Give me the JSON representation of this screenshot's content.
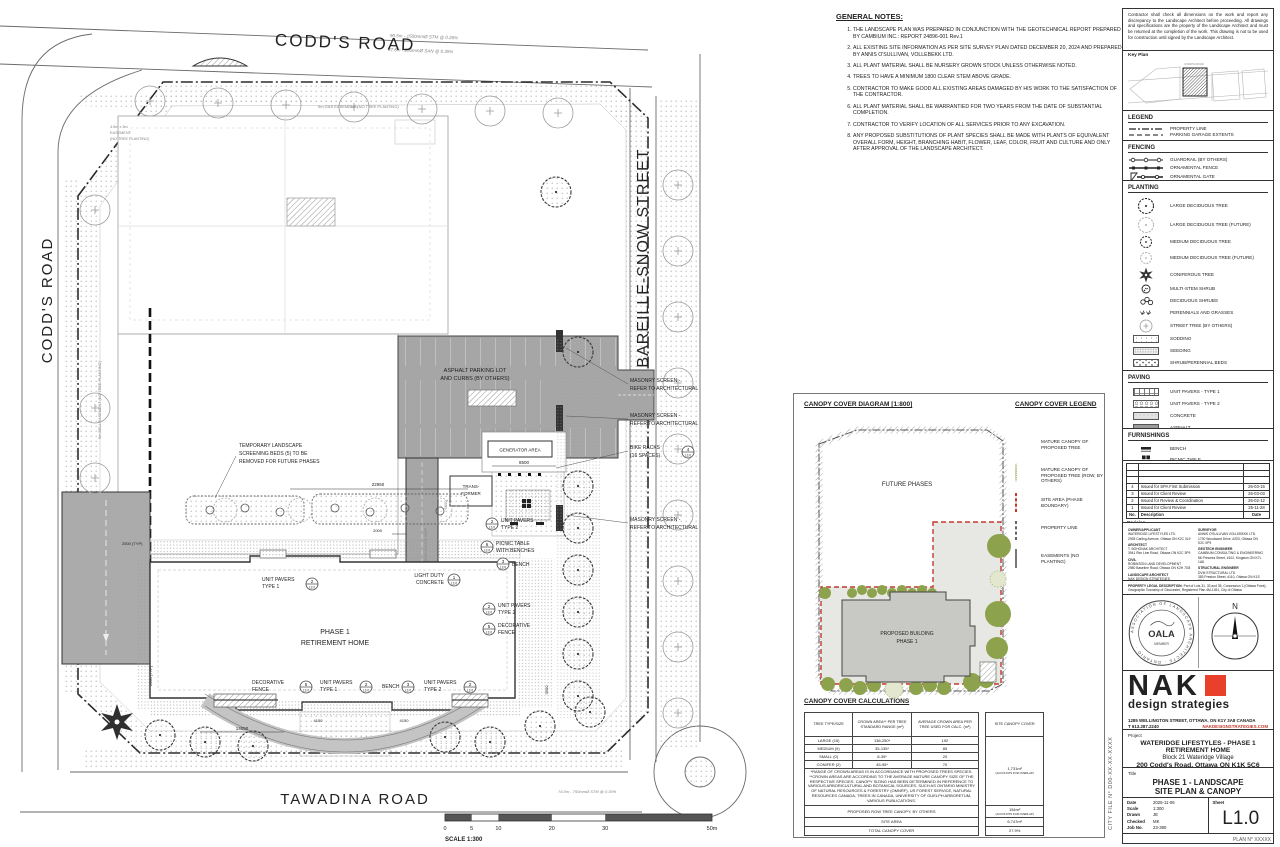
{
  "plan": {
    "street_top": "CODD'S ROAD",
    "street_left": "CODD'S ROAD",
    "street_right": "BAREILLE-SNOW STREET",
    "street_bottom": "TAWADINA ROAD",
    "asphalt1": "ASPHALT PARKING LOT",
    "asphalt2": "AND CURBS (BY OTHERS)",
    "generator": "GENERATOR AREA",
    "trans1": "TRANS-",
    "trans2": "FORMER",
    "masonry1": "MASONRY SCREEN -",
    "masonry2": "REFER TO ARCHITECTURAL",
    "bike1": "BIKE RACKS",
    "bike2": "(16 SPACES)",
    "temp1": "TEMPORARY LANDSCAPE",
    "temp2": "SCREENING BEDS (5) TO BE",
    "temp3": "REMOVED FOR FUTURE PHASES",
    "bldg1": "PHASE 1",
    "bldg2": "RETIREMENT HOME",
    "ramp": "EXTERNAL PARKING GARAGE RAMP",
    "lbl_up": "UNIT PAVERS",
    "lbl_t1": "TYPE 1",
    "lbl_t2": "TYPE 2",
    "lbl_picnic1": "PICNIC TABLE",
    "lbl_picnic2": "WITH BENCHES",
    "lbl_bench": "BENCH",
    "lbl_ldc1": "LIGHT DUTY",
    "lbl_ldc2": "CONCRETE",
    "lbl_fence1": "DECORATIVE",
    "lbl_fence2": "FENCE",
    "b1": "1",
    "b2": "2",
    "b3": "3",
    "b4": "4",
    "b5": "5",
    "b6": "6",
    "sheetref": "L3.0",
    "d22950": "22950",
    "d2000": "2000",
    "d8500": "8500",
    "d2500": "2500 (TYP)",
    "d3500": "3500",
    "d14050": "14050",
    "d4150": "4150",
    "d6500": "6500",
    "e_gas": "5m GAS EASEMENT (NO TREE PLANTING)",
    "e_corner1": "4.5m x 5m",
    "e_corner2": "EASEMENT",
    "e_corner3": "(NO TREE PLANTING)",
    "e_bell": "5m BELL EASEMENT (NO TREE PLANTING)",
    "survey1": "90.5m - 1500mmØ STM @ 0.26%",
    "survey2": "87.8m - 250mmØ SAN @ 0.35%",
    "survey3": "74.0m - 750mmØ STM @ 0.30%",
    "scale_label": "SCALE 1:300",
    "s0": "0",
    "s5": "5",
    "s10": "10",
    "s20": "20",
    "s30": "30",
    "s50": "50m"
  },
  "notes": {
    "title": "GENERAL NOTES:",
    "items": [
      "THE LANDSCAPE PLAN WAS PREPARED IN CONJUNCTION WITH THE GEOTECHNICAL REPORT PREPARED BY CAMBIUM INC.: REPORT 24896-001 Rev.1",
      "ALL EXISTING SITE INFORMATION AS PER SITE SURVEY PLAN DATED DECEMBER 20, 2024 AND PREPARED BY ANNIS O'SULLIVAN, VOLLEBEKK LTD.",
      "ALL PLANT MATERIAL SHALL BE NURSERY GROWN STOCK UNLESS OTHERWISE NOTED.",
      "TREES TO HAVE A MINIMUM 1800 CLEAR STEM ABOVE GRADE.",
      "CONTRACTOR TO MAKE GOOD ALL EXISTING AREAS DAMAGED BY HIS WORK TO THE  SATISFACTION OF THE CONTRACTOR.",
      "ALL PLANT MATERIAL SHALL BE WARRANTIED  FOR TWO YEARS FROM THE DATE OF  SUBSTANTIAL COMPLETION.",
      "CONTRACTOR TO VERIFY LOCATION OF ALL SERVICES PRIOR TO ANY EXCAVATION.",
      "ANY PROPOSED SUBSTITUTIONS OF PLANT SPECIES SHALL BE MADE WITH PLANTS OF EQUIVALENT OVERALL FORM, HEIGHT, BRANCHING HABIT, FLOWER, LEAF, COLOR, FRUIT AND CULTURE AND ONLY AFTER APPROVAL OF THE LANDSCAPE ARCHITECT."
    ]
  },
  "canopy": {
    "diagram_title": "CANOPY COVER DIAGRAM [1:800]",
    "legend_title": "CANOPY COVER LEGEND",
    "future": "FUTURE PHASES",
    "bldg1": "PROPOSED BUILDING",
    "bldg2": "PHASE 1",
    "legend": [
      "MATURE CANOPY OF PROPOSED TREE",
      "MATURE CANOPY OF PROPOSED TREE (ROW, BY OTHERS)",
      "SITE AREA (PHASE BOUNDARY)",
      "PROPERTY LINE",
      "EASEMENTS (NO PLANTING)"
    ],
    "calc_title": "CANOPY COVER CALCULATIONS",
    "h1": "TREE TYPE/SIZE",
    "h2": "CROWN AREA** PER TREE STANDARD RANGE (m²)",
    "h3": "AVERAGE CROWN AREA PER TREE USED FOR CALC. (m²)",
    "h4": "SITE CANOPY COVER",
    "rows": [
      [
        "LARGE (15)",
        "136-250*",
        "192"
      ],
      [
        "MEDIUM (9)",
        "35-135*",
        "85"
      ],
      [
        "SMALL (0)",
        "8-35*",
        "20"
      ],
      [
        "CONIFER (2)",
        "45-95*",
        "70"
      ]
    ],
    "site_canopy": "1,731m²",
    "overlap": "(ACCOUNTS FOR OVERLAP)",
    "footnote": "*RANGE OF CROWN AREAS IS IN ACCORDANCE WITH PROPOSED TREES SPECIES. **CROWN AREAS ARE ACCORDING TO THE AVERAGE MATURE CANOPY SIZE OF THE RESPECTIVE SPECIES. CANOPY SIZING HAS BEEN DETERMINED IN REFERENCE TO VARIOUS ARBORICULTURAL AND BOTANICAL SOURCES, SUCH AS ONTARIO MINISTRY OF NATURAL RESOURCES & FORESTRY (OMNRF), US FOREST SERVICE, NATURAL RESOURCES CANADA, TREES IN CANADA, UNIVERSITY OF GUELPH ARBORETUM, VARIOUS PUBLICATIONS.",
    "row_label": "PROPOSED ROW TREE CANOPY, BY OTHERS",
    "row_value": "154m²",
    "sa_label": "SITE AREA",
    "sa_value": "6,747m²",
    "total_label": "TOTAL CANOPY COVER",
    "total_value": "27.9%"
  },
  "tb": {
    "disclaimer": "Contractor shall check all dimensions on the work and report any discrepancy to the Landscape Architect before proceeding.  All drawings and specifications are the property of the Landscape Architect and must be returned at the completion of the work.  This drawing is not to be used for construction until signed by the Landscape Architect.",
    "keyplan": "Key Plan",
    "keyplan_road": "CODD'S ROAD",
    "legend_title": "LEGEND",
    "legend": [
      "PROPERTY LINE",
      "PARKING GARAGE EXTENTS"
    ],
    "fencing_title": "FENCING",
    "fencing": [
      "GUARDRAIL (BY OTHERS)",
      "ORNAMENTAL FENCE",
      "ORNAMENTAL GATE"
    ],
    "planting_title": "PLANTING",
    "planting": [
      "LARGE DECIDUOUS TREE",
      "LARGE DECIDUOUS TREE (FUTURE)",
      "MEDIUM DECIDUOUS TREE",
      "MEDIUM DECIDUOUS TREE (FUTURE)",
      "CONIFEROUS TREE",
      "MULTI-STEM SHRUB",
      "DECIDUOUS SHRUBS",
      "PERENNIALS AND GRASSES",
      "STREET TREE (BY OTHERS)",
      "SODDING",
      "SEEDING",
      "SHRUB/PERENNIAL BEDS",
      "MULCH"
    ],
    "paving_title": "PAVING",
    "paving": [
      "UNIT PAVERS - TYPE 1",
      "UNIT PAVERS - TYPE 2",
      "CONCRETE",
      "ASPHALT"
    ],
    "furnishings_title": "FURNISHINGS",
    "furnishings": [
      "BENCH",
      "PICNIC TABLE"
    ],
    "rev_rows": [
      [
        "4",
        "Issued for SPA First Submission",
        "26-03-15"
      ],
      [
        "3",
        "Issued for Client Review",
        "26-03-03"
      ],
      [
        "2",
        "Issued for Review & Coordination",
        "26-02-12"
      ],
      [
        "1",
        "Issued for Client Review",
        "25-11-28"
      ]
    ],
    "rev_no": "No.",
    "rev_desc": "Description",
    "rev_date": "Date",
    "rev_footer": "Revision",
    "cons_left": [
      {
        "role": "OWNER/APPLICANT",
        "firm": "WATERIDGE LIFESTYLES LTD.",
        "addr": "2935 Carling Avenue, Ottawa ON K2C 3L9"
      },
      {
        "role": "ARCHITECT",
        "firm": "T. BOHONAK ARCHITECT",
        "addr": "3941 Rim Line Road, Ottawa ON K2C 3P9"
      },
      {
        "role": "CIVIL",
        "firm": "ROBINSON LAND DEVELOPMENT",
        "addr": "2980 Baseline Road, Ottawa ON K2H 7G8"
      },
      {
        "role": "LANDSCAPE ARCHITECT",
        "firm": "NAK DESIGN STRATEGIES",
        "addr": "1285 Wellington St. W., Ottawa ON K1Y 3A8"
      },
      {
        "role": "MECHANICAL & ELECTRICAL",
        "firm": "GOODKEY, WEEDMARK & ASSOCIATES LTD.",
        "addr": "1688 Woodward Drive, Ottawa ON K2C 3R8"
      }
    ],
    "cons_right": [
      {
        "role": "SURVEYOR",
        "firm": "ANNIS O'SULLIVAN VOLLEBEKK LTD.",
        "addr": "1730 Woodward Drive, #203, Ottawa ON K2C 0P9"
      },
      {
        "role": "GEOTECH ENGINEER",
        "firm": "CAMBIUM CONSULTING & ENGINEERING",
        "addr": "86 Princess Street, #102, Kingston ON K7L 1A8"
      },
      {
        "role": "STRUCTURAL ENGINEER",
        "firm": "DVM STRUCTURAL LTD.",
        "addr": "383 Preston Street, #110, Ottawa ON K1S 5N4"
      }
    ],
    "legal1": "PROPERTY LEGAL DESCRIPTION:",
    "legal2": "Part of Lots 31, 33 and 35, Concession 1 (Ottawa Front), Geographic Township of Gloucester, Registered Plan 4M-1451, City of Ottawa",
    "seal_org": "ASSOCIATION OF LANDSCAPE ARCHITECTS · ONTARIO ·",
    "seal_acronym": "OALA",
    "seal_member": "MEMBER",
    "north": "N",
    "firm_name": "NAK",
    "firm_tag": "design strategies",
    "addr": "1285 WELLINGTON STREET, OTTAWA, ON K1Y 3A8 CANADA",
    "phone": "T 613.287.2240",
    "web": "NAKDESIGNSTRATEGIES.COM",
    "project_label": "Project",
    "proj1": "WATERIDGE LIFESTYLES - PHASE 1 RETIREMENT HOME",
    "proj2": "Block 21 Wateridge Village",
    "proj3": "200 Codd's Road, Ottawa ON K1K 5C6",
    "title_label": "Title",
    "title1": "PHASE 1 - LANDSCAPE",
    "title2": "SITE PLAN & CANOPY",
    "f_date_l": "Date",
    "f_date": "2025-11-06",
    "f_scale_l": "Scale",
    "f_scale": "1:300",
    "f_drawn_l": "Drawn",
    "f_drawn": "JE",
    "f_checked_l": "Checked",
    "f_checked": "MK",
    "f_job_l": "Job No.",
    "f_job": "23-390",
    "f_sheet_l": "Sheet",
    "f_sheet": "L1.0",
    "city_file": "CITY FILE N°  D00-XX-XX-XXXX",
    "plan_no": "PLAN N°  XXXXX"
  }
}
